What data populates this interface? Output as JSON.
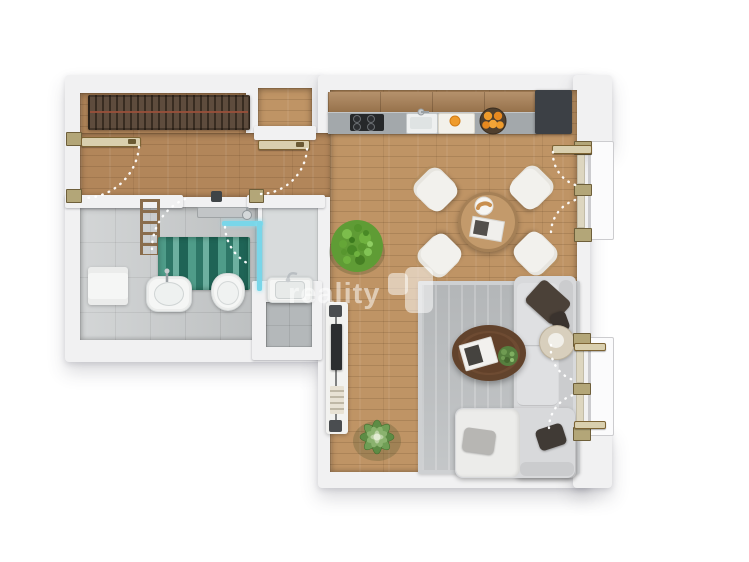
{
  "watermark": {
    "text": "reality",
    "logo": "reality-logo"
  },
  "colors": {
    "wall": "#f1f1f2",
    "balcony": "#fbfbfc",
    "balconyEdge": "#cccccf",
    "wood": "#bf9465",
    "woodDark": "#b2865a",
    "wardrobe": "#5e4c3d",
    "wardrobeRod": "#99503a",
    "tile": "#c7cacb",
    "showerFloor": "#d8dbdc",
    "wcFloor": "#b4b8ba",
    "rugA": "#4f9c89",
    "rugB": "#2e7767",
    "rugC": "#6db0a0",
    "rugD": "#1f6456",
    "glass": "#79d6e9",
    "white": "#f5f6f5",
    "chrome": "#c9cdd0",
    "bronze": "#8a6d4c",
    "cabinet": "#a87e52",
    "counter": "#a3a8ab",
    "cooktop": "#26282a",
    "unit": "#3c4045",
    "orange": "#ef9b2b",
    "bowl": "#503f2d",
    "table": "#c39a6b",
    "chair": "#f2f1ed",
    "chairWood": "#b08c5e",
    "bush": "#5f9c35",
    "rugLiving": "#bdc0c2",
    "rugEdge": "#ced0d2",
    "sofa": "#d8d9db",
    "sofaBack": "#cbccce",
    "sofaSeat": "#dfe0e2",
    "sofaWhite": "#ececea",
    "pillow": "#4b4138",
    "pillowGray": "#b7b6b3",
    "pillowDark2": "#403a35",
    "coffee": "#6e4b32",
    "coffeeDark": "#5a3a24",
    "side": "#d8cfbd",
    "console": "#f2f2f0",
    "tv": "#2c2e30",
    "speaker": "#4a4d50",
    "post": "#b3a678",
    "postEdge": "#6e5f3a",
    "pane": "#ddd6c0",
    "leaf": "#d9cfae",
    "leafEdge": "#7d6434",
    "watermarkColor": "rgba(255,255,255,0.52)"
  },
  "elements": {
    "wardrobe": "built-in wardrobe with hangers",
    "entry-door": "entry swing door",
    "hall-door": "hallway swing door",
    "bathroom": "bathroom with washbasin, toilet, teal rug, towel radiator, glass shower",
    "shower-room": "walk-in shower room",
    "wc-room": "small room with washbasin",
    "kitchen": "kitchen counter with cooktop, sink, cutting board, fruit bowl, tall dark unit",
    "dining": "round wooden table with four white chairs, plate and magazine",
    "living": "gray rug, L-shaped sofa with pillows, coffee table, side table, TV console",
    "plants": "round bush plant, succulent plant, coffee-table plant",
    "french-doors": "two double balcony doors on right wall"
  }
}
